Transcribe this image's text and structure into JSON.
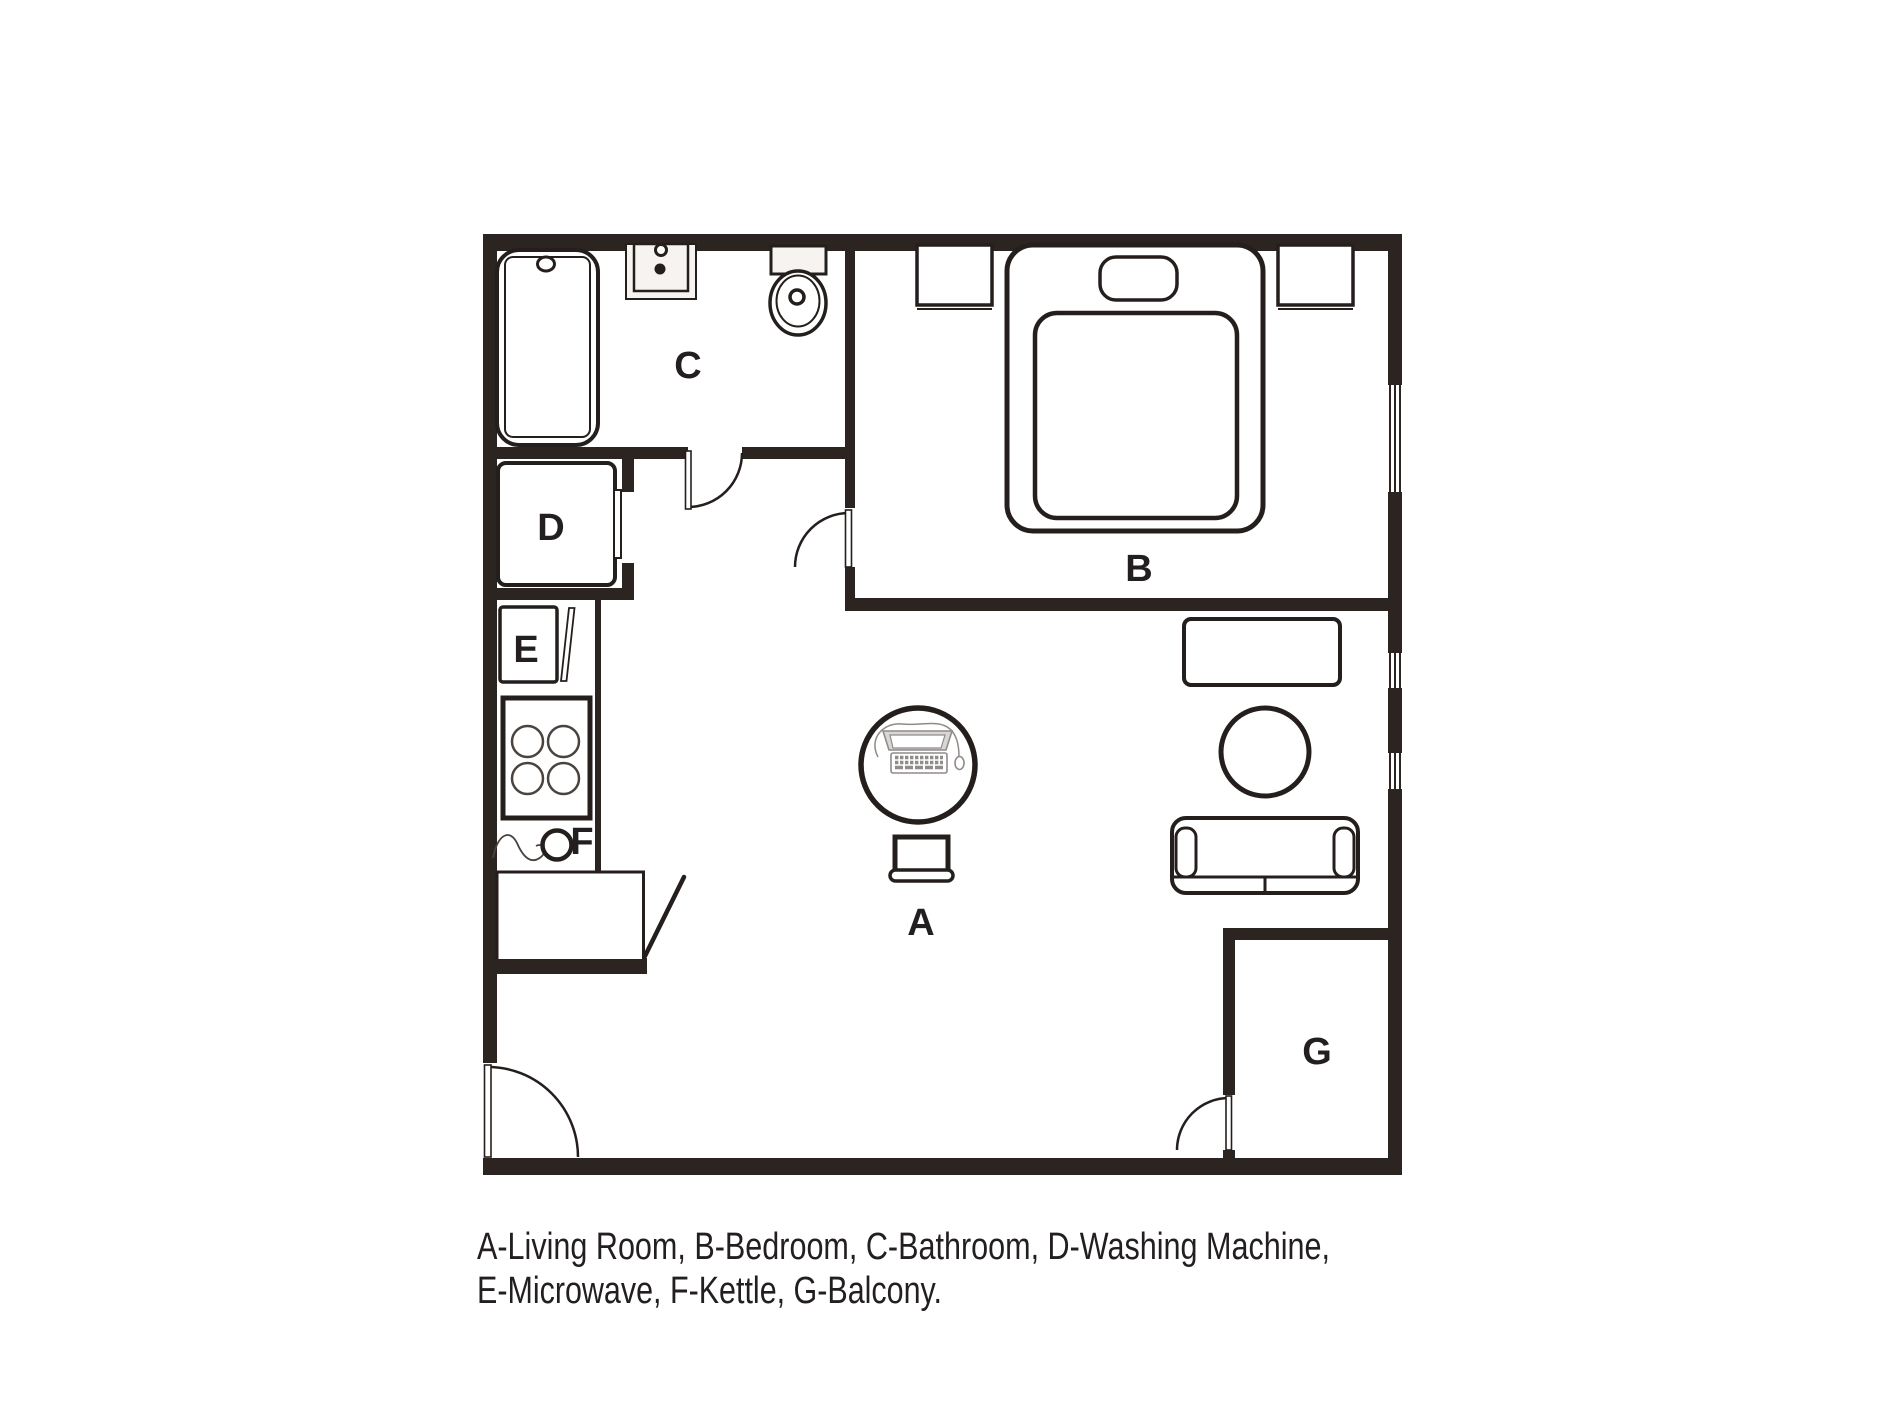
{
  "floor_plan": {
    "labels": {
      "living_room": "A",
      "bedroom": "B",
      "bathroom": "C",
      "washing_machine": "D",
      "microwave": "E",
      "kettle": "F",
      "balcony": "G"
    },
    "legend": {
      "line1": "A-Living Room, B-Bedroom, C-Bathroom, D-Washing Machine,",
      "line2": "E-Microwave, F-Kettle, G-Balcony.",
      "entries": [
        {
          "key": "A",
          "name": "Living Room"
        },
        {
          "key": "B",
          "name": "Bedroom"
        },
        {
          "key": "C",
          "name": "Bathroom"
        },
        {
          "key": "D",
          "name": "Washing Machine"
        },
        {
          "key": "E",
          "name": "Microwave"
        },
        {
          "key": "F",
          "name": "Kettle"
        },
        {
          "key": "G",
          "name": "Balcony"
        }
      ]
    },
    "colors": {
      "wall": "#2b2421",
      "line": "#241f1d",
      "fixture_fill": "#f6f3f1",
      "computer_line": "#8f8c8a",
      "background": "#ffffff"
    }
  }
}
